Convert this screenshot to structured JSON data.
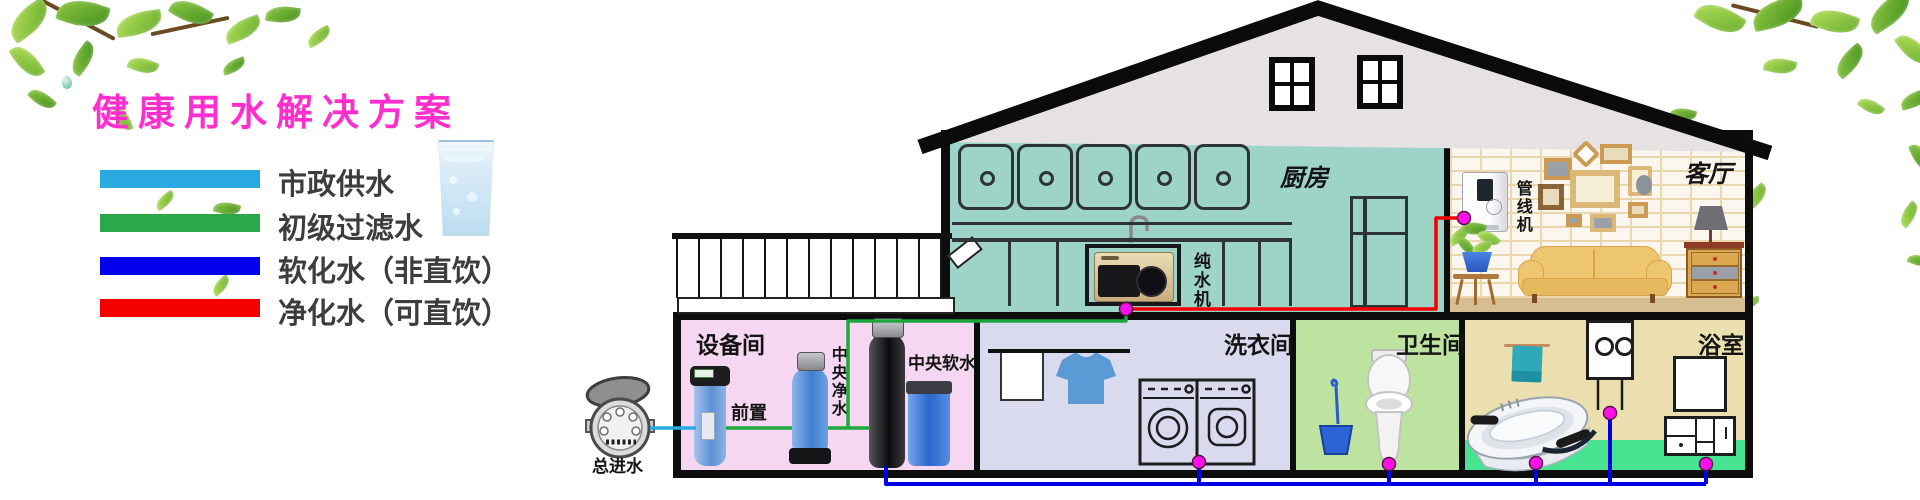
{
  "title": "健康用水解决方案",
  "legend": {
    "items": [
      {
        "label": "市政供水",
        "color": "#29ABE2"
      },
      {
        "label": "初级过滤水",
        "color": "#2BA84C"
      },
      {
        "label": "软化水（非直饮）",
        "color": "#0000EE"
      },
      {
        "label": "净化水（可直饮）",
        "color": "#F40000"
      }
    ]
  },
  "rooms": {
    "kitchen": {
      "label": "厨房"
    },
    "living": {
      "label": "客厅"
    },
    "equipment": {
      "label": "设备间"
    },
    "laundry": {
      "label": "洗衣间"
    },
    "toilet": {
      "label": "卫生间"
    },
    "bath": {
      "label": "浴室"
    }
  },
  "devices": {
    "main_inlet": {
      "label": "总进水"
    },
    "prefilter": {
      "label": "前置"
    },
    "central_filter": {
      "label": "中央净水"
    },
    "central_softener": {
      "label": "中央软水"
    },
    "ro_machine": {
      "label": "纯水机"
    },
    "pipeline_dispenser": {
      "label": "管线机"
    }
  },
  "pipes": {
    "municipal": "#29ABE2",
    "filtered": "#1CA83C",
    "softened": "#0000E6",
    "purified": "#F40000",
    "joint_dot": "#FF10E8"
  }
}
